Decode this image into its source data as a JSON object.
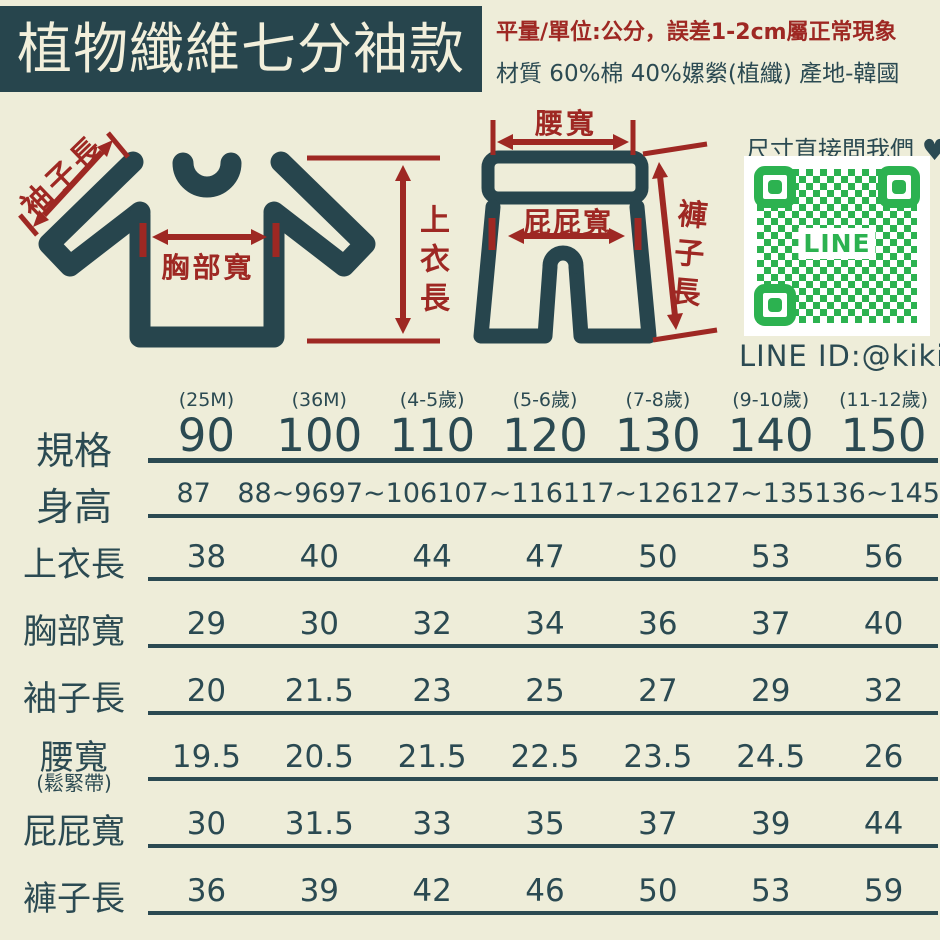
{
  "colors": {
    "background": "#eeedd9",
    "ink": "#2b4a52",
    "accent_red": "#9e2823",
    "banner_bg": "#27454d",
    "banner_text": "#f2efdb",
    "qr_green": "#2cb250",
    "qr_bg": "#ffffff"
  },
  "header": {
    "title": "植物纖維七分袖款",
    "measure_note": "平量/單位:公分，誤差1-2cm屬正常現象",
    "material_note": "材質 60%棉 40%嫘縈(植纖) 產地-韓國"
  },
  "diagrams": {
    "shirt": {
      "sleeve_label": "袖子長",
      "chest_label": "胸部寬",
      "length_label": "上衣長"
    },
    "pants": {
      "waist_label": "腰寬",
      "hip_label": "屁屁寬",
      "length_label": "褲子長"
    }
  },
  "contact": {
    "prompt": "尺寸直接問我們",
    "heart": "♥",
    "qr_center_text": "LINE",
    "line_id": "LINE ID:@kikis"
  },
  "chart_data": {
    "type": "table",
    "title": "植物纖維七分袖款",
    "unit": "公分",
    "header_label": "規格",
    "columns": [
      {
        "age": "(25M)",
        "size": "90"
      },
      {
        "age": "(36M)",
        "size": "100"
      },
      {
        "age": "(4-5歲)",
        "size": "110"
      },
      {
        "age": "(5-6歲)",
        "size": "120"
      },
      {
        "age": "(7-8歲)",
        "size": "130"
      },
      {
        "age": "(9-10歲)",
        "size": "140"
      },
      {
        "age": "(11-12歲)",
        "size": "150"
      }
    ],
    "rows": [
      {
        "label": "身高",
        "values": [
          "87",
          "88~96",
          "97~106",
          "107~116",
          "117~126",
          "127~135",
          "136~145"
        ]
      },
      {
        "label": "上衣長",
        "values": [
          "38",
          "40",
          "44",
          "47",
          "50",
          "53",
          "56"
        ]
      },
      {
        "label": "胸部寬",
        "values": [
          "29",
          "30",
          "32",
          "34",
          "36",
          "37",
          "40"
        ]
      },
      {
        "label": "袖子長",
        "values": [
          "20",
          "21.5",
          "23",
          "25",
          "27",
          "29",
          "32"
        ]
      },
      {
        "label": "腰寬",
        "sublabel": "(鬆緊帶)",
        "values": [
          "19.5",
          "20.5",
          "21.5",
          "22.5",
          "23.5",
          "24.5",
          "26"
        ]
      },
      {
        "label": "屁屁寬",
        "values": [
          "30",
          "31.5",
          "33",
          "35",
          "37",
          "39",
          "44"
        ]
      },
      {
        "label": "褲子長",
        "values": [
          "36",
          "39",
          "42",
          "46",
          "50",
          "53",
          "59"
        ]
      }
    ]
  }
}
